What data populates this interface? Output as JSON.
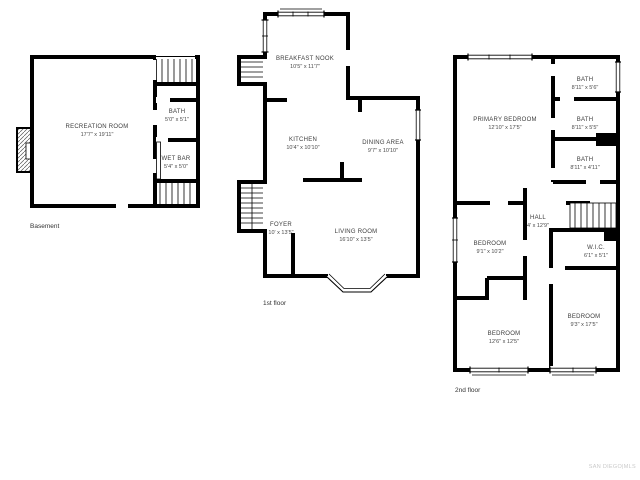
{
  "watermark": "SAN DIEGO|MLS",
  "basement": {
    "label": "Basement",
    "rooms": [
      {
        "name": "RECREATION ROOM",
        "dims": "17'7\" x 19'11\""
      },
      {
        "name": "BATH",
        "dims": "5'0\" x 5'1\""
      },
      {
        "name": "WET BAR",
        "dims": "5'4\" x 5'0\""
      }
    ]
  },
  "first_floor": {
    "label": "1st floor",
    "rooms": [
      {
        "name": "BREAKFAST NOOK",
        "dims": "10'5\" x 11'7\""
      },
      {
        "name": "KITCHEN",
        "dims": "10'4\" x 10'10\""
      },
      {
        "name": "DINING AREA",
        "dims": "9'7\" x 10'10\""
      },
      {
        "name": "FOYER",
        "dims": "10' x 13'5\""
      },
      {
        "name": "LIVING ROOM",
        "dims": "16'10\" x 13'5\""
      }
    ]
  },
  "second_floor": {
    "label": "2nd floor",
    "rooms": [
      {
        "name": "PRIMARY BEDROOM",
        "dims": "12'10\" x 17'5\""
      },
      {
        "name": "BATH",
        "dims": "8'11\" x 5'6\""
      },
      {
        "name": "BATH",
        "dims": "8'11\" x 5'5\""
      },
      {
        "name": "BATH",
        "dims": "8'11\" x 4'11\""
      },
      {
        "name": "HALL",
        "dims": "4' x 12'9\""
      },
      {
        "name": "BEDROOM",
        "dims": "9'1\" x 10'2\""
      },
      {
        "name": "W.I.C.",
        "dims": "6'1\" x 5'1\""
      },
      {
        "name": "BEDROOM",
        "dims": "9'3\" x 17'5\""
      },
      {
        "name": "BEDROOM",
        "dims": "12'6\" x 12'5\""
      }
    ]
  }
}
